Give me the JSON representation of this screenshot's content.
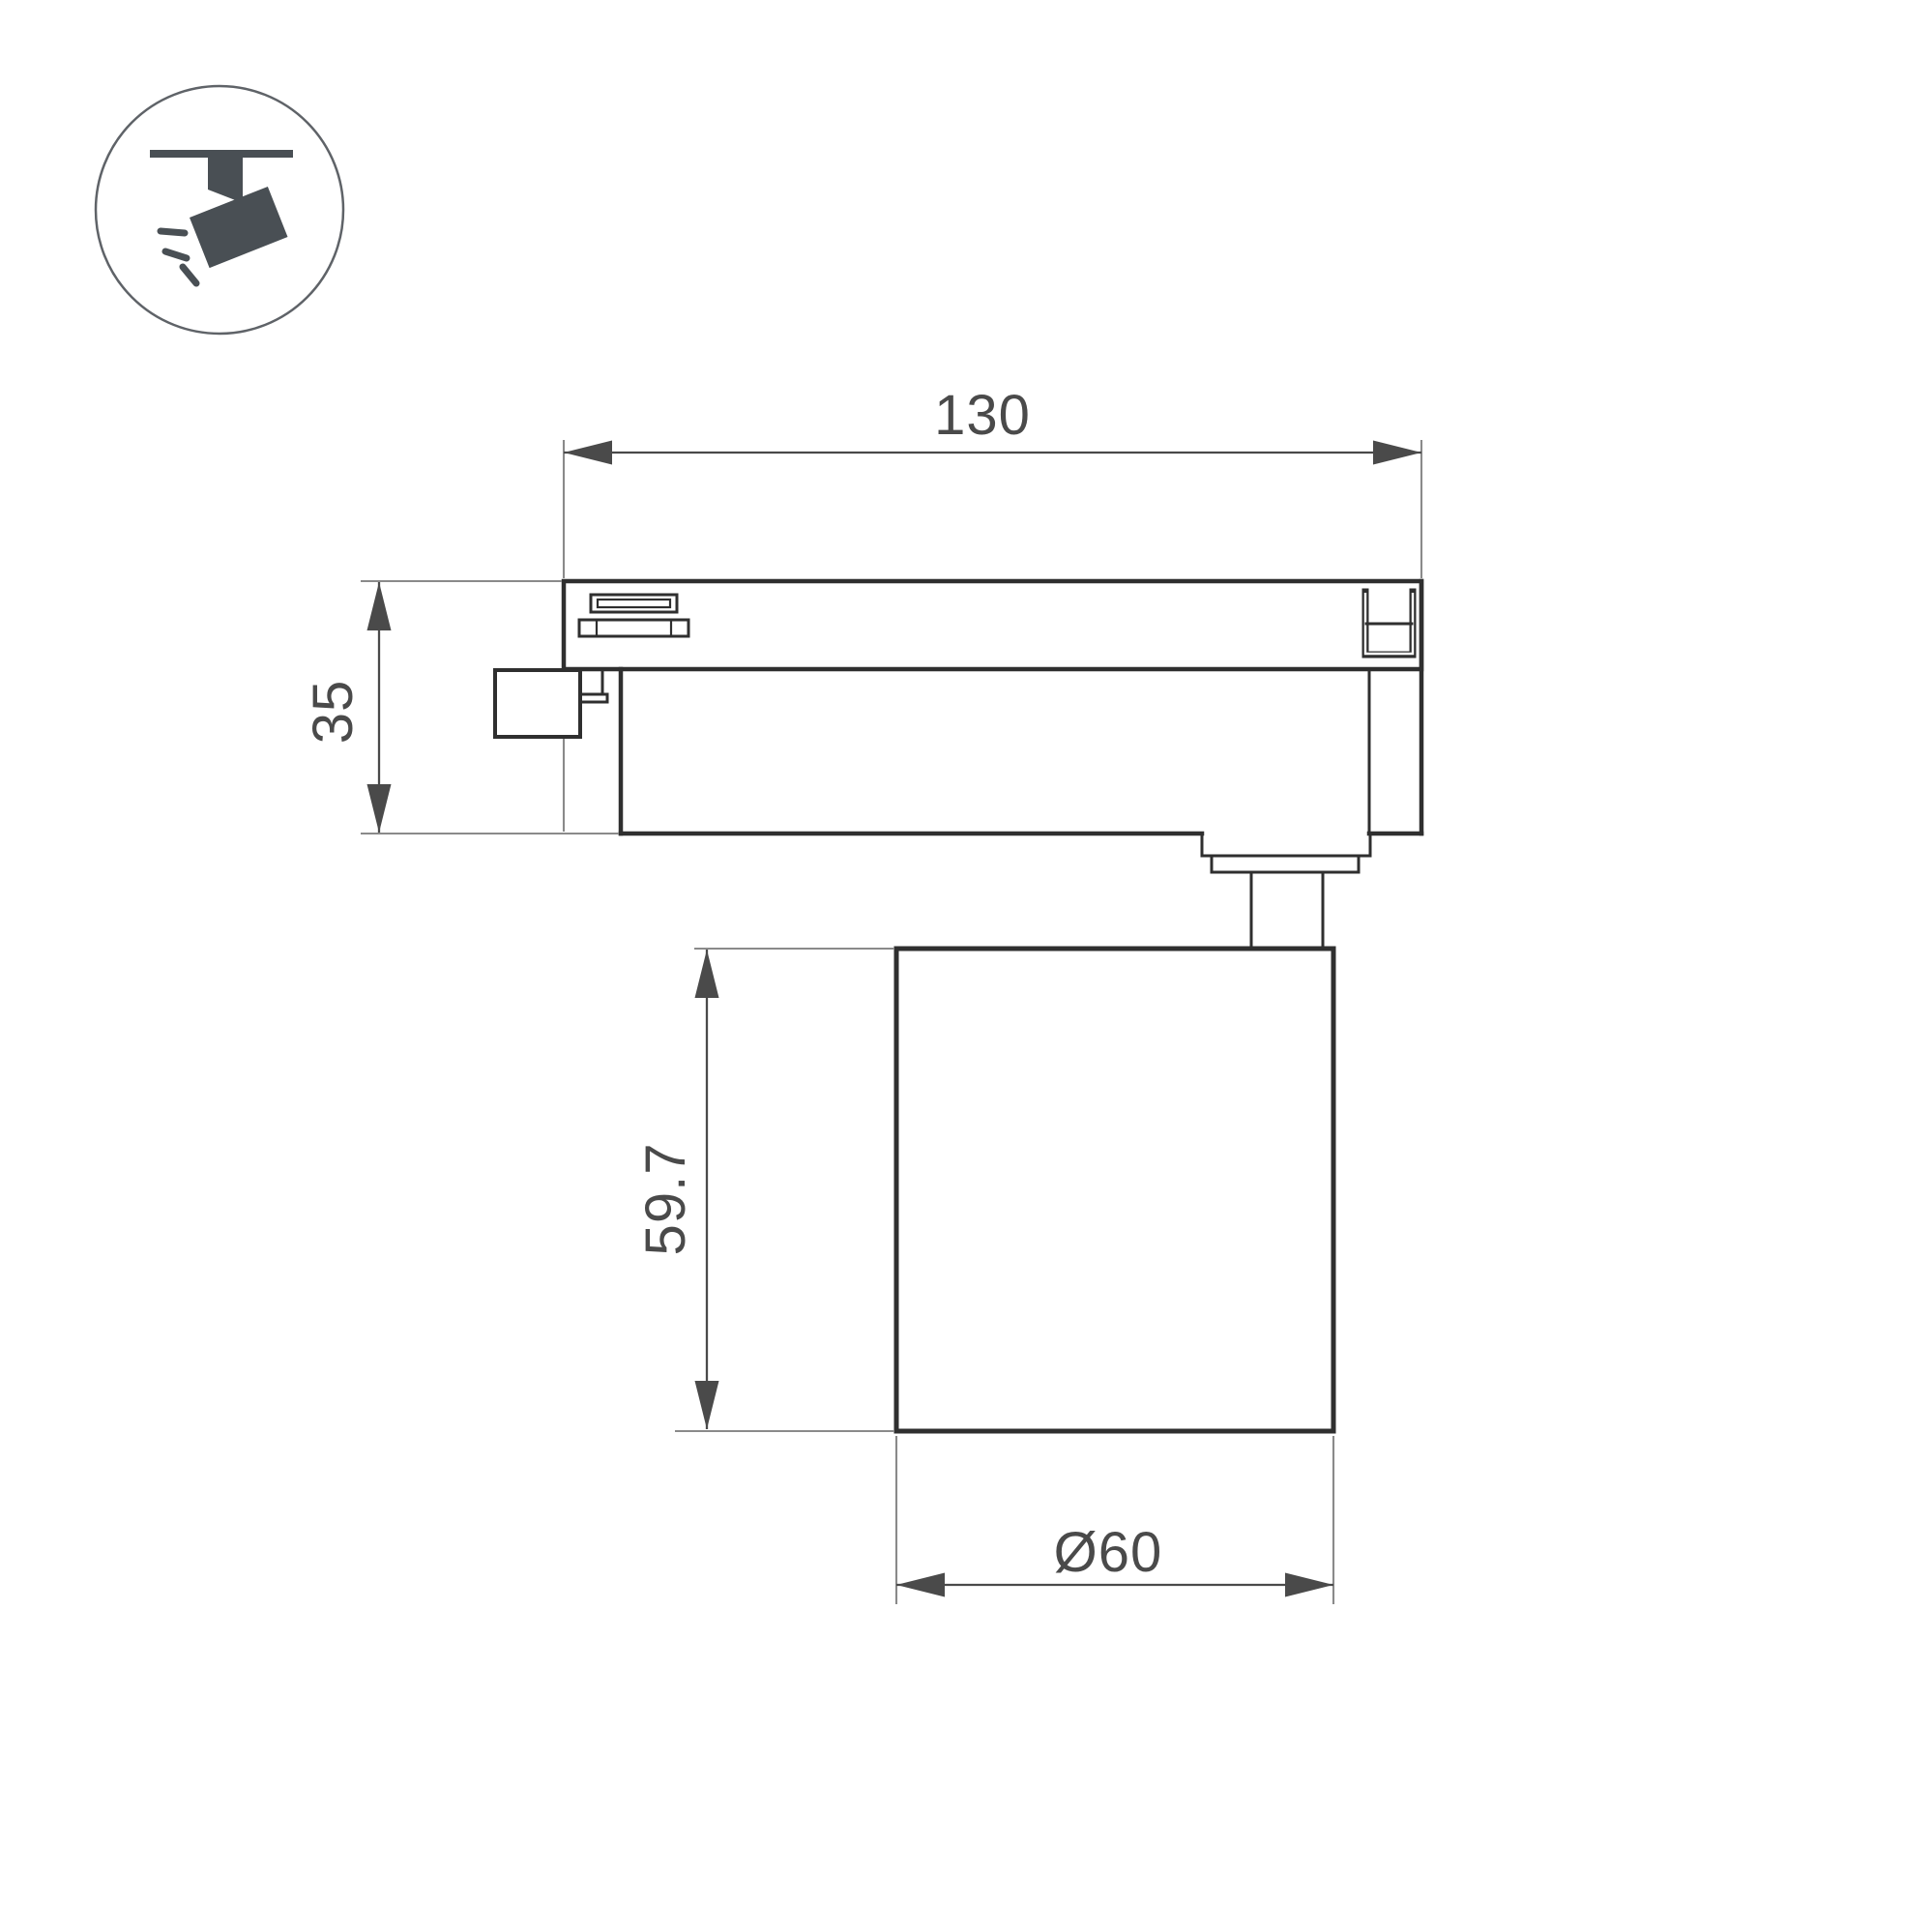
{
  "meta": {
    "description": "Technical dimension drawing of a track-mounted spotlight, side view, with pictogram badge"
  },
  "icon": {
    "name": "track-spotlight-icon"
  },
  "dimensions": {
    "track_adapter_length": "130",
    "track_adapter_height": "35",
    "lamp_body_height": "59.7",
    "lamp_body_diameter": "Ø60"
  },
  "colors": {
    "background": "#ffffff",
    "outline": "#2f2f2f",
    "dimension": "#4a4a4a",
    "extension": "#8a8a8a",
    "icon_glyph": "#494f54",
    "icon_ring": "#5f6368"
  }
}
